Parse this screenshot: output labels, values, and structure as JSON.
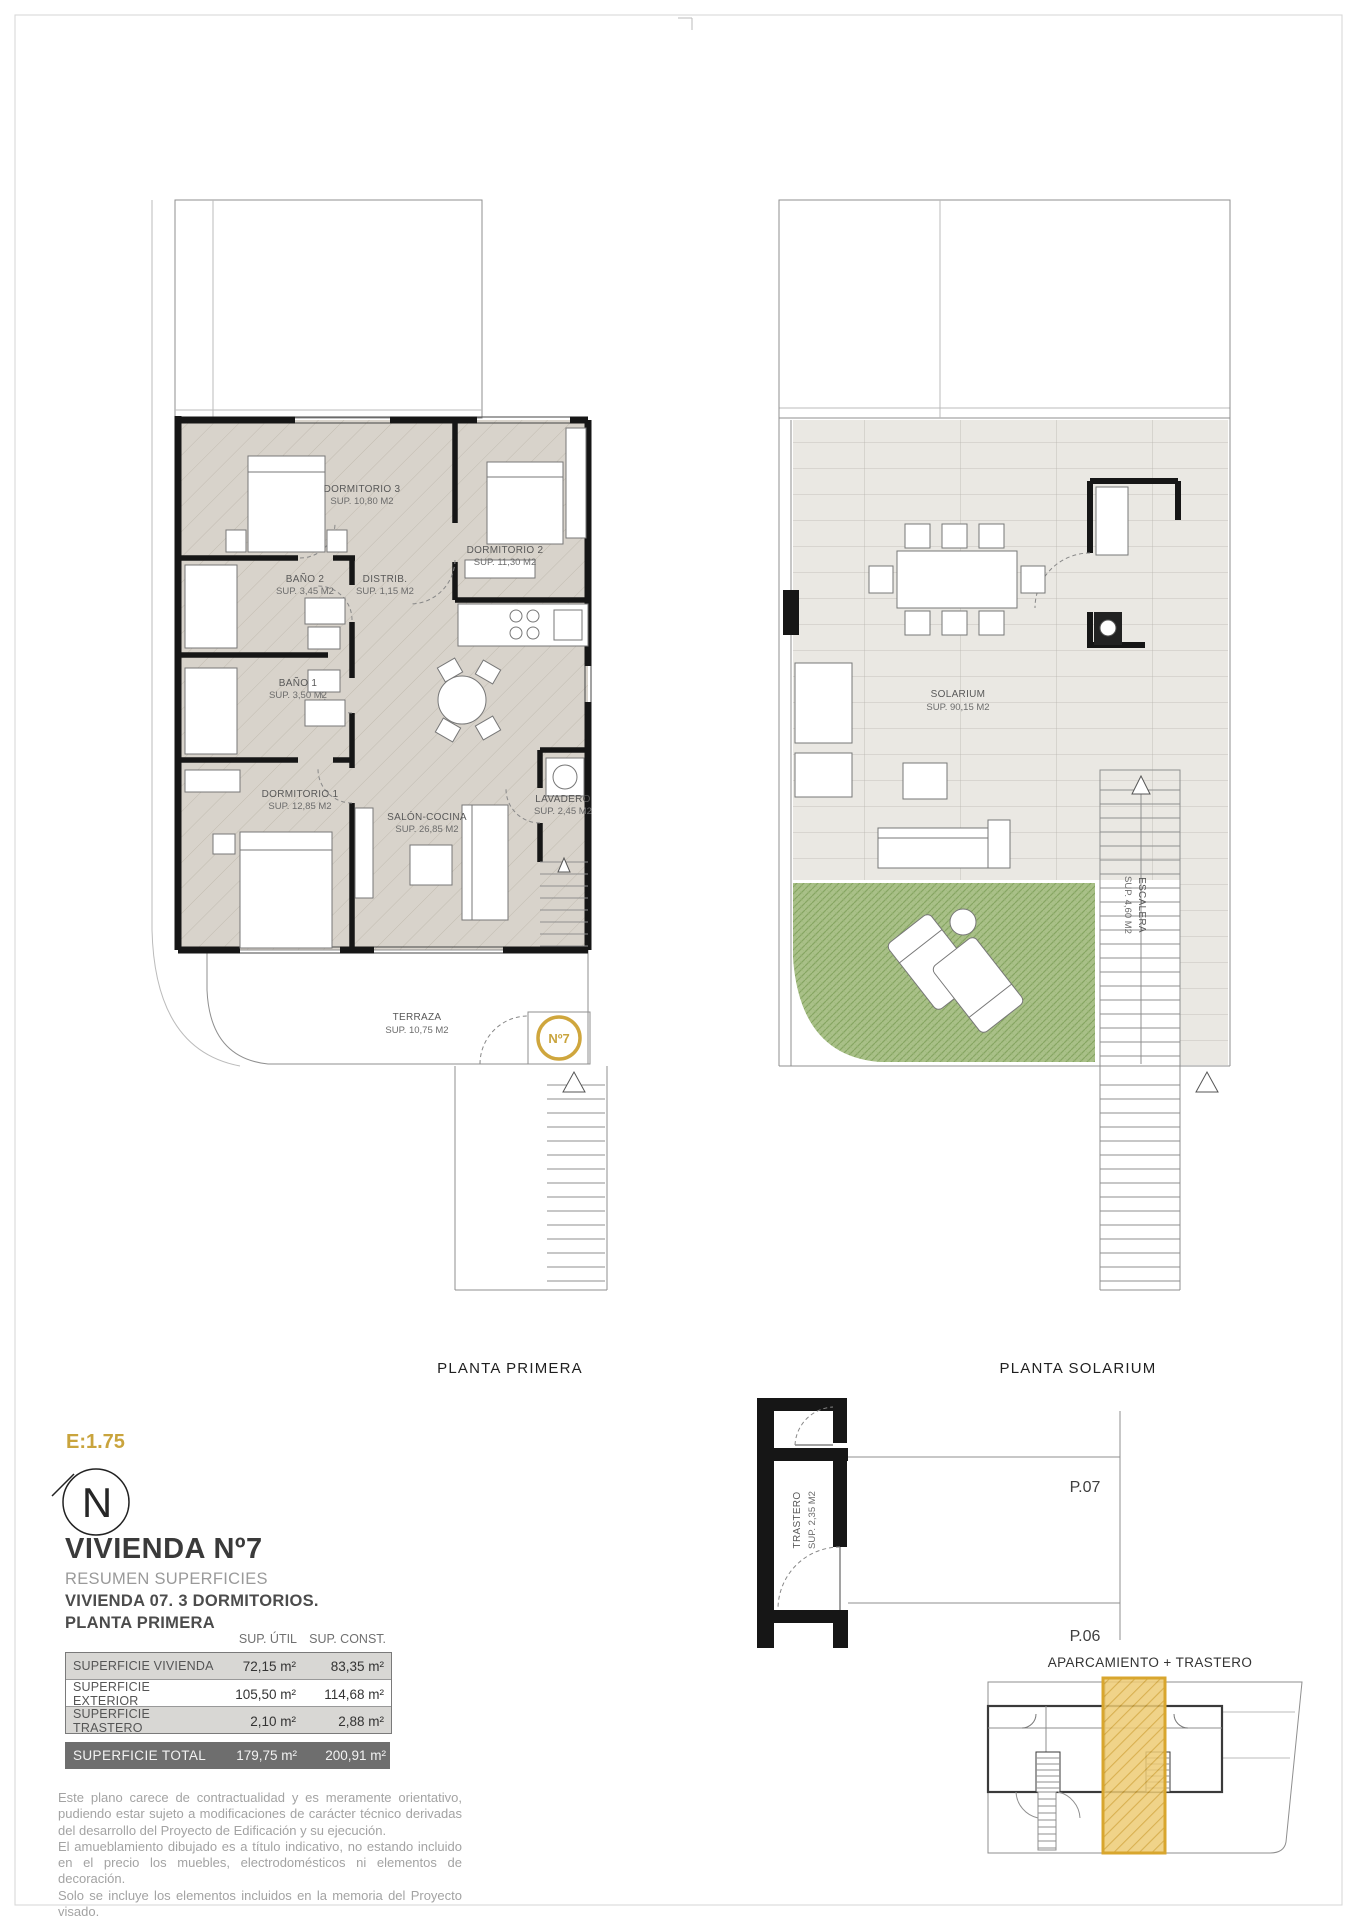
{
  "accent_gold": "#c9a43d",
  "plans": {
    "planta_primera": {
      "caption": "PLANTA PRIMERA",
      "unit_badge": "Nº7",
      "rooms": [
        {
          "name": "DORMITORIO 3",
          "sup": "SUP. 10,80 M2"
        },
        {
          "name": "DORMITORIO 2",
          "sup": "SUP. 11,30 M2"
        },
        {
          "name": "BAÑO 2",
          "sup": "SUP. 3,45 M2"
        },
        {
          "name": "DISTRIB.",
          "sup": "SUP. 1,15 M2"
        },
        {
          "name": "BAÑO 1",
          "sup": "SUP. 3,50 M2"
        },
        {
          "name": "DORMITORIO 1",
          "sup": "SUP. 12,85 M2"
        },
        {
          "name": "SALÓN-COCINA",
          "sup": "SUP. 26,85 M2"
        },
        {
          "name": "LAVADERO",
          "sup": "SUP. 2,45 M2"
        },
        {
          "name": "TERRAZA",
          "sup": "SUP. 10,75 M2"
        }
      ]
    },
    "planta_solarium": {
      "caption": "PLANTA SOLARIUM",
      "rooms": [
        {
          "name": "SOLARIUM",
          "sup": "SUP. 90,15 M2"
        },
        {
          "name": "ESCALERA",
          "sup": "SUP. 4,60 M2"
        }
      ]
    }
  },
  "info": {
    "scale": "E:1.75",
    "north_letter": "N",
    "title": "VIVIENDA Nº7",
    "subtitle": "RESUMEN SUPERFICIES",
    "line1": "VIVIENDA 07. 3 DORMITORIOS.",
    "line2": "PLANTA PRIMERA"
  },
  "table": {
    "col_util": "SUP. ÚTIL",
    "col_const": "SUP. CONST.",
    "rows": [
      {
        "label": "SUPERFICIE VIVIENDA",
        "util": "72,15 m²",
        "const": "83,35 m²"
      },
      {
        "label": "SUPERFICIE EXTERIOR",
        "util": "105,50 m²",
        "const": "114,68 m²"
      },
      {
        "label": "SUPERFICIE TRASTERO",
        "util": "2,10 m²",
        "const": "2,88 m²"
      }
    ],
    "total": {
      "label": "SUPERFICIE TOTAL",
      "util": "179,75 m²",
      "const": "200,91 m²"
    }
  },
  "parking": {
    "trastero_name": "TRASTERO",
    "trastero_sup": "SUP. 2,35 M2",
    "space_top": "P.07",
    "space_bottom": "P.06",
    "title": "APARCAMIENTO + TRASTERO"
  },
  "disclaimer": {
    "p1": "Este plano carece de contractualidad y es meramente orientativo, pudiendo estar sujeto a modificaciones de carácter técnico derivadas del desarrollo del Proyecto de Edificación y su ejecución.",
    "p2": "El amueblamiento dibujado es a título indicativo, no estando incluido en el precio los muebles, electrodomésticos ni elementos de decoración.",
    "p3": "Solo se incluye los elementos incluidos en la memoria del Proyecto visado."
  }
}
